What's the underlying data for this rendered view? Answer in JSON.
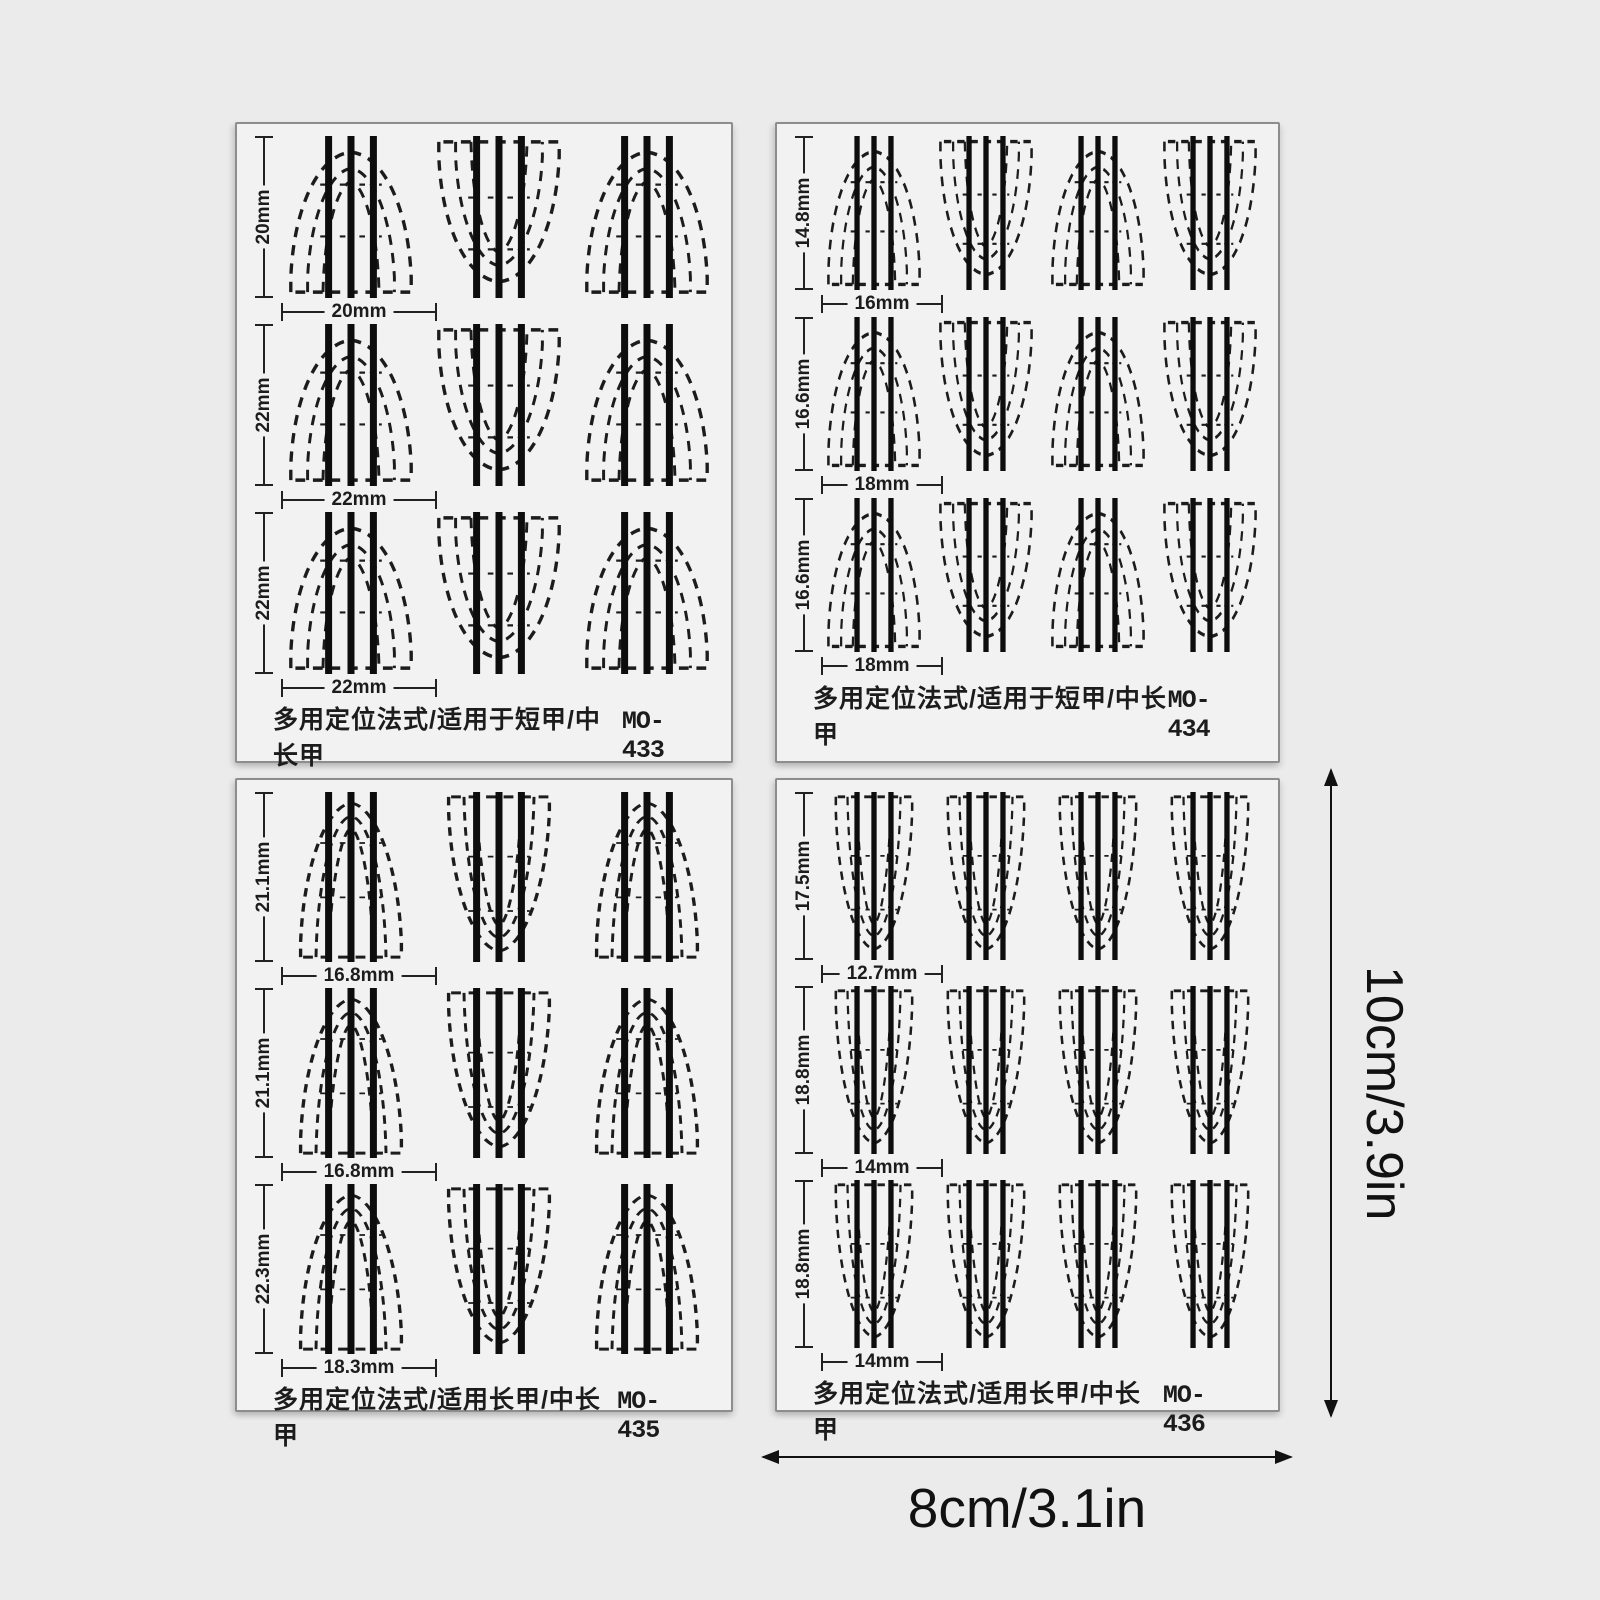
{
  "page": {
    "background_color": "#ebebeb",
    "sheet_color": "#f2f2f2",
    "ink_color": "#1c1c1c"
  },
  "dimensions": {
    "height_label": "10cm/3.9in",
    "width_label": "8cm/3.1in"
  },
  "sheets": [
    {
      "code": "MO-433",
      "title": "多用定位法式/适用于短甲/中长甲",
      "grid": {
        "cells_per_row": 3,
        "cell_style": "short",
        "orientations": [
          "up",
          "down",
          "up"
        ]
      },
      "rows": [
        {
          "height_label": "20mm",
          "width_label": "20mm"
        },
        {
          "height_label": "22mm",
          "width_label": "22mm"
        },
        {
          "height_label": "22mm",
          "width_label": "22mm"
        }
      ]
    },
    {
      "code": "MO-434",
      "title": "多用定位法式/适用于短甲/中长甲",
      "grid": {
        "cells_per_row": 4,
        "cell_style": "short",
        "orientations": [
          "up",
          "down",
          "up",
          "down"
        ]
      },
      "rows": [
        {
          "height_label": "14.8mm",
          "width_label": "16mm"
        },
        {
          "height_label": "16.6mm",
          "width_label": "18mm"
        },
        {
          "height_label": "16.6mm",
          "width_label": "18mm"
        }
      ]
    },
    {
      "code": "MO-435",
      "title": "多用定位法式/适用长甲/中长甲",
      "grid": {
        "cells_per_row": 3,
        "cell_style": "long",
        "orientations": [
          "up",
          "down",
          "up"
        ]
      },
      "rows": [
        {
          "height_label": "21.1mm",
          "width_label": "16.8mm"
        },
        {
          "height_label": "21.1mm",
          "width_label": "16.8mm"
        },
        {
          "height_label": "22.3mm",
          "width_label": "18.3mm"
        }
      ]
    },
    {
      "code": "MO-436",
      "title": "多用定位法式/适用长甲/中长甲",
      "grid": {
        "cells_per_row": 4,
        "cell_style": "long",
        "orientations": [
          "down",
          "down",
          "down",
          "down"
        ]
      },
      "rows": [
        {
          "height_label": "17.5mm",
          "width_label": "12.7mm"
        },
        {
          "height_label": "18.8mm",
          "width_label": "14mm"
        },
        {
          "height_label": "18.8mm",
          "width_label": "14mm"
        }
      ]
    }
  ]
}
